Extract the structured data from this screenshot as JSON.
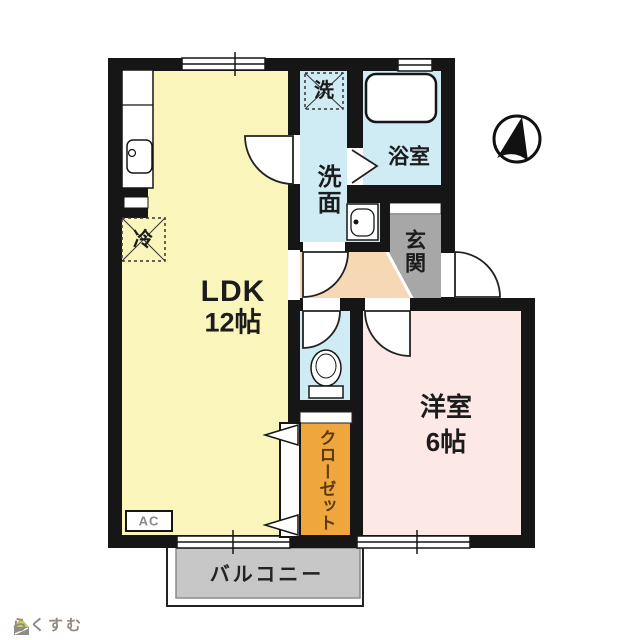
{
  "colors": {
    "ldk": "#f9f5bb",
    "bedroom": "#fce9e6",
    "wet": "#cfecf5",
    "hall": "#f6d9b4",
    "entrance": "#a7a7a7",
    "closet": "#eea63d",
    "balcony": "#c7c7c7",
    "wall": "#161616",
    "closet_text": "#5c3a10",
    "logo_text": "#91887f",
    "logo_roof": "#c5c96b"
  },
  "rooms": {
    "ldk": {
      "name": "LDK",
      "size": "12帖"
    },
    "western_room": {
      "name": "洋室",
      "size": "6帖"
    },
    "washroom": {
      "name": "洗面"
    },
    "bathroom": {
      "name": "浴室"
    },
    "entrance": {
      "name": "玄関"
    },
    "closet": {
      "name": "クローゼット"
    },
    "balcony": {
      "name": "バルコニー"
    }
  },
  "fixtures": {
    "washer_box": "洗",
    "fridge_box": "冷",
    "ac_unit": "AC"
  },
  "footer": {
    "logo_text": "らくすむ"
  }
}
